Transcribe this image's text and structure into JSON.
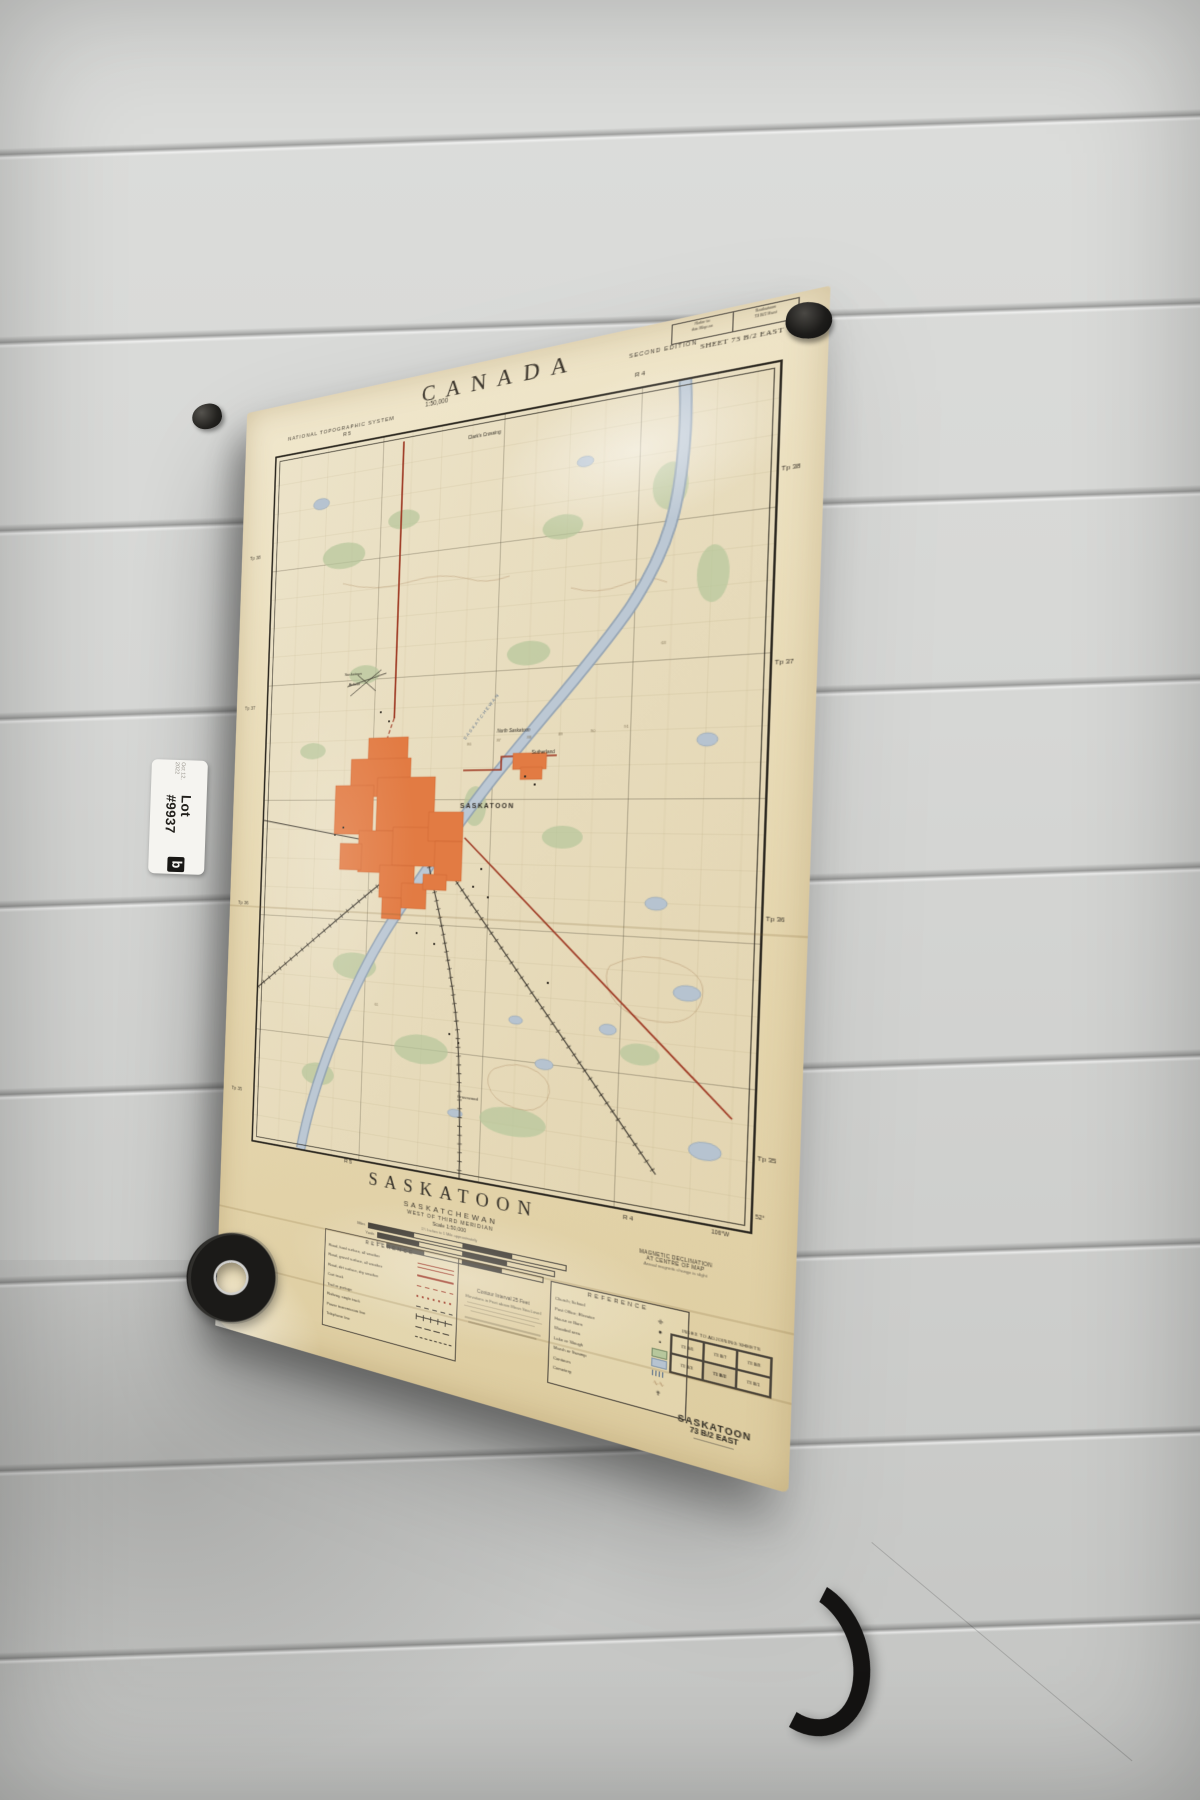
{
  "tag": {
    "lot_number": "Lot #9937",
    "date": "Oct 12, 2022",
    "logo": "b"
  },
  "poster": {
    "header": {
      "system": "NATIONAL TOPOGRAPHIC SYSTEM",
      "scale": "1:50,000",
      "country": "CANADA",
      "edition": "SECOND EDITION",
      "refer": {
        "l1": "Refer to",
        "l2": "this Map as",
        "r1": "Saskatoon",
        "r2": "73 B/2 East"
      },
      "sheet": "SHEET 73 B/2 EAST",
      "range_left": "R 5",
      "range_right": "R 4"
    },
    "margins": {
      "tp_labels": [
        "Tp 38",
        "Tp 37",
        "Tp 36",
        "Tp 35"
      ],
      "range_left": "R 5",
      "range_right": "R 4",
      "lat": "52°",
      "lon": "106°W"
    },
    "map_labels": {
      "clarks": "Clark's Crossing",
      "north_saskatoon": "North Saskatoon",
      "airfield_1": "Saskatoon",
      "airfield_2": "Airfield",
      "city": "SASKATOON",
      "sutherland": "Sutherland",
      "grasswood": "Grasswood",
      "river": "SASKATCHEWAN"
    },
    "grid_numbers": [
      "86",
      "87",
      "88",
      "89",
      "90",
      "91",
      "61",
      "63"
    ],
    "title_block": {
      "title": "SASKATOON",
      "province": "SASKATCHEWAN",
      "meridian": "WEST OF THIRD MERIDIAN",
      "scale": "Scale 1:50,000",
      "scale_note": "1¼ Inches to 1 Mile approximately",
      "bar_units": [
        "Miles",
        "Yards",
        "Feet"
      ]
    },
    "notes": {
      "contour_1": "Contour Interval 25 Feet",
      "contour_2": "Elevations in Feet above Mean Sea Level",
      "declination_1": "MAGNETIC DECLINATION",
      "declination_2": "AT CENTRE OF MAP",
      "declination_3": "Annual magnetic change is slight"
    },
    "reference_left": {
      "title": "REFERENCE",
      "items": [
        {
          "label": "Road, hard surface, all weather",
          "sym": "red-double"
        },
        {
          "label": "Road, gravel surface, all weather",
          "sym": "red-solid"
        },
        {
          "label": "Road, dirt surface, dry weather",
          "sym": "red-dash"
        },
        {
          "label": "Cart track",
          "sym": "red-dot"
        },
        {
          "label": "Trail or portage",
          "sym": "black-dash"
        },
        {
          "label": "Railway, single track",
          "sym": "rail"
        },
        {
          "label": "Power transmission line",
          "sym": "power"
        },
        {
          "label": "Telephone line",
          "sym": "telephone"
        }
      ]
    },
    "reference_right": {
      "title": "REFERENCE",
      "items": [
        {
          "label": "Church; School",
          "sym": "church"
        },
        {
          "label": "Post Office; Elevator",
          "sym": "dot"
        },
        {
          "label": "House or Barn",
          "sym": "square"
        },
        {
          "label": "Wooded area",
          "sym": "wood"
        },
        {
          "label": "Lake or Slough",
          "sym": "lake"
        },
        {
          "label": "Marsh or Swamp",
          "sym": "marsh"
        },
        {
          "label": "Contours",
          "sym": "contour"
        },
        {
          "label": "Cemetery",
          "sym": "cemetery"
        }
      ]
    },
    "index": {
      "title": "INDEX TO ADJOINING SHEETS",
      "cells": [
        "73 B/6",
        "73 B/7",
        "73 B/8",
        "73 B/3",
        "73 B/2",
        "73 B/1"
      ]
    },
    "corner": {
      "name": "SASKATOON",
      "sheet": "73 B/2 EAST"
    }
  },
  "colors": {
    "wall": "#d6d7d5",
    "paper": "#ebdfbd",
    "city_orange": "#e27b43",
    "river_blue": "#bcc8d4",
    "road_red": "#9e3823",
    "woods_green": "#b7c79c",
    "ink": "#3c362c"
  }
}
